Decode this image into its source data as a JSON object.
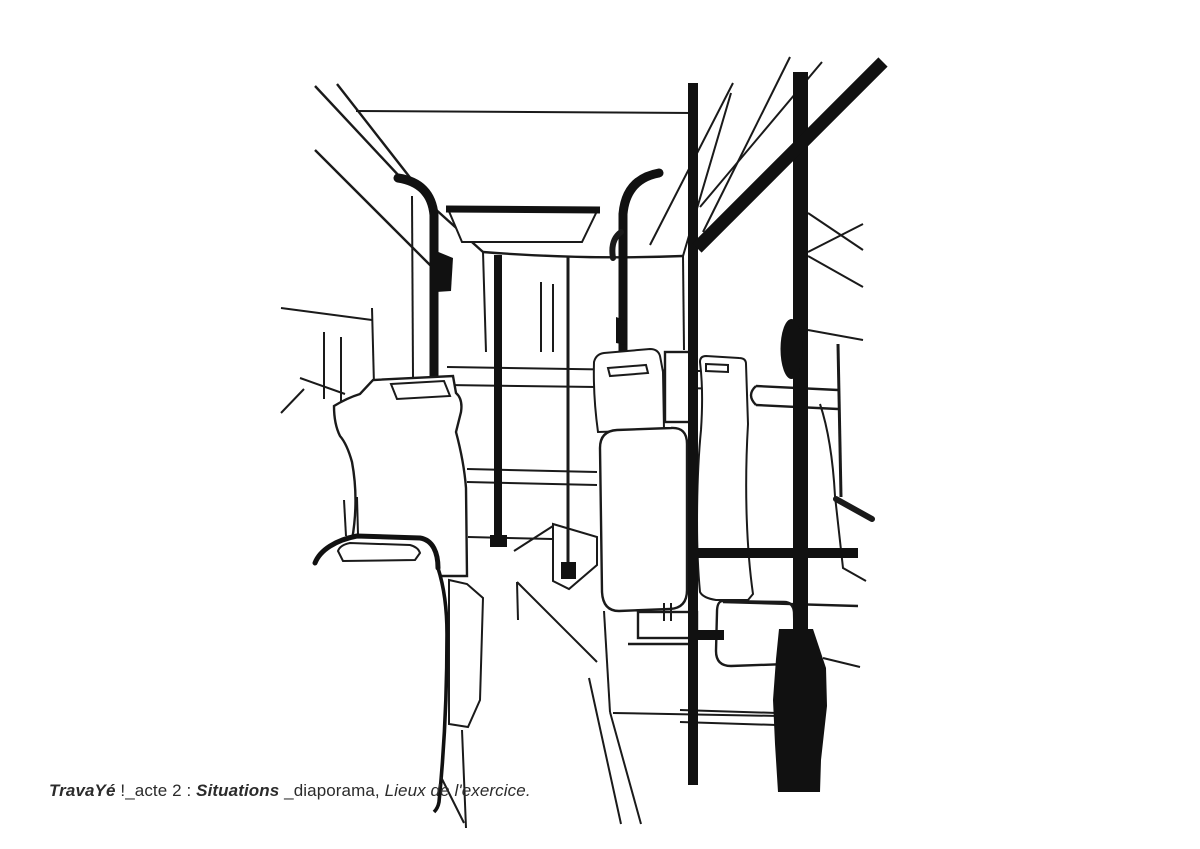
{
  "page": {
    "background_color": "#ffffff",
    "ink_color": "#1a1a1a"
  },
  "illustration": {
    "name": "bus-interior-line-drawing",
    "subject": "interior of a city bus seen from the central aisle with seats, grab poles, ceiling hatch and windows"
  },
  "caption": {
    "full_text": "TravaYé !_acte 2 : Situations _diaporama, Lieux de l'exercice.",
    "color": "#2b2b2b",
    "segments": [
      {
        "text": "TravaYé",
        "style": "bold-italic"
      },
      {
        "text": " !_acte 2 : ",
        "style": "regular"
      },
      {
        "text": "Situations",
        "style": "bold-italic"
      },
      {
        "text": " _diaporama, ",
        "style": "regular"
      },
      {
        "text": "Lieux de l'exercice.",
        "style": "italic"
      }
    ]
  }
}
